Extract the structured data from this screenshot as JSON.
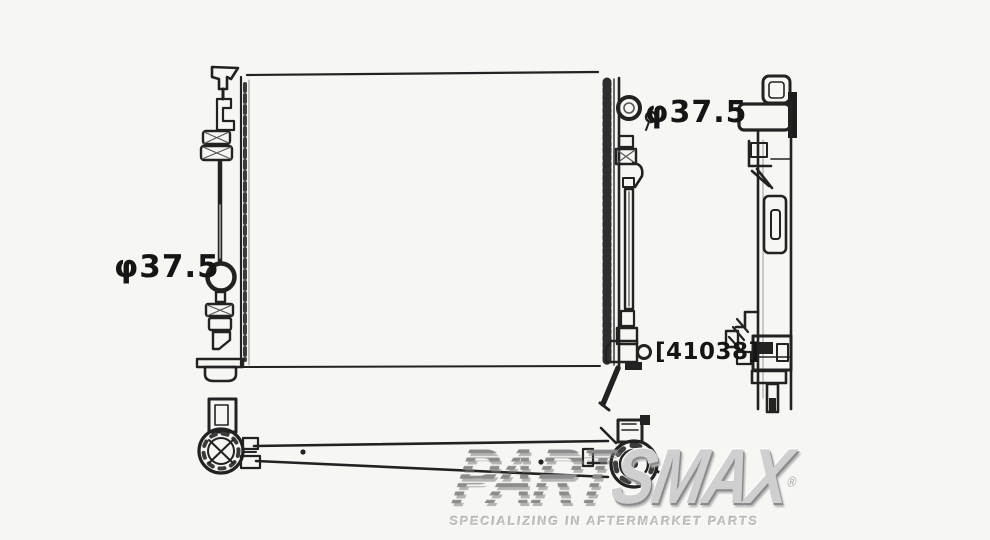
{
  "diagram": {
    "labels": {
      "left_port_diameter": "φ37.5",
      "top_right_port_diameter": "φ37.5",
      "part_number": "[41038]"
    }
  },
  "watermark": {
    "brand_striped": "PART",
    "brand_solid": "SMAX",
    "registered": "®",
    "tagline": "SPECIALIZING IN AFTERMARKET PARTS"
  },
  "colors": {
    "background": "#f6f6f3",
    "line": "#222222",
    "watermark_gray": "#cfcfcf"
  }
}
